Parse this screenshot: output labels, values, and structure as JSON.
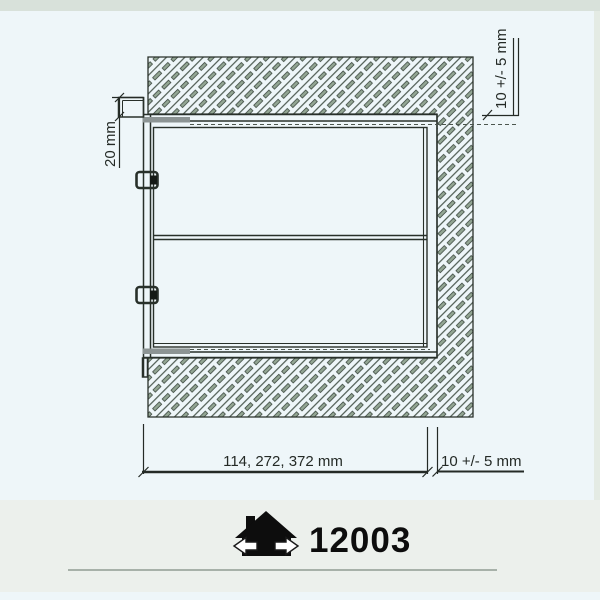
{
  "diagram": {
    "type": "installation-cross-section",
    "product_number": "12003",
    "dimensions": {
      "flange_depth_label": "20 mm",
      "side_tolerance_label": "10 +/- 5 mm",
      "width_variants_label": "114, 272, 372 mm",
      "bottom_tolerance_label": "10 +/- 5 mm"
    },
    "icons": [
      {
        "name": "house-logo",
        "description": "black house silhouette with white left and right arrows"
      }
    ],
    "colors": {
      "background": "#eef6f9",
      "top_band": "#d8e1da",
      "bottom_band": "#ecf0ec",
      "bottom_rule": "#a7b1a9",
      "line": "#28302a",
      "hatch_thin": "#404f44",
      "hatch_thick_fill": "#93a694",
      "frame_bar": "#8c9494",
      "logo": "#0d0d0d"
    }
  }
}
